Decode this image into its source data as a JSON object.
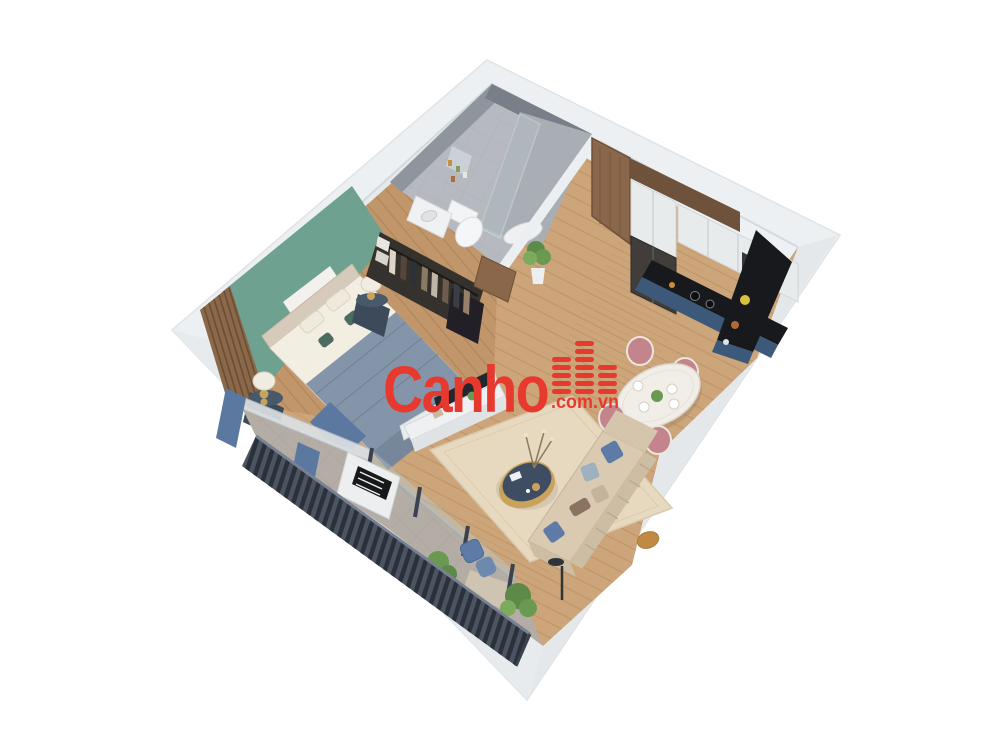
{
  "meta": {
    "description": "3D isometric render of a one-bedroom apartment floor plan, viewed from above on a white background",
    "background": "#ffffff"
  },
  "watermark": {
    "brand": "Canho",
    "suffix": ".com.vn",
    "color": "#e8392f",
    "logo_icon": "building-bars-icon"
  },
  "scene": {
    "rooms": [
      "bedroom",
      "bathroom",
      "entrance",
      "kitchen",
      "dining-area",
      "living-room",
      "balcony"
    ]
  },
  "palette": {
    "wall_white": "#edf0f2",
    "wall_band_right": "#e4e8eb",
    "wall_band_left": "#e7ebee",
    "wall_face_tl": "#e6eaec",
    "wall_face_tr": "#eef1f3",
    "floor_wood": "#cda57a",
    "floor_wood_bedroom": "#c0966a",
    "bathroom_floor": "#b6bac0",
    "bathroom_wall": "#8e959d",
    "shower_wall": "#787f89",
    "green_wall": "#6fa190",
    "slat_wood": "#8a6848",
    "door_wood": "#8a664a",
    "cabinet_white": "#e8ebec",
    "cabinet_navy": "#3d5979",
    "counter_black": "#17191d",
    "fridge_dark": "#403d3a",
    "table_white": "#f1eee8",
    "chair_pink": "#c4848b",
    "sofa_beige": "#d9cab1",
    "sofa_back": "#cdbda3",
    "rug_beige": "#e7d9c0",
    "pillow_blue": "#5d7ba6",
    "coffee_table_navy": "#3f4d63",
    "gold": "#c9a35c",
    "bed_blanket": "#8595a9",
    "bed_drape": "#5b79a0",
    "balcony_tile": "#b3ada6",
    "railing_dark": "#4b5460",
    "plant_green": "#6a9a52"
  }
}
